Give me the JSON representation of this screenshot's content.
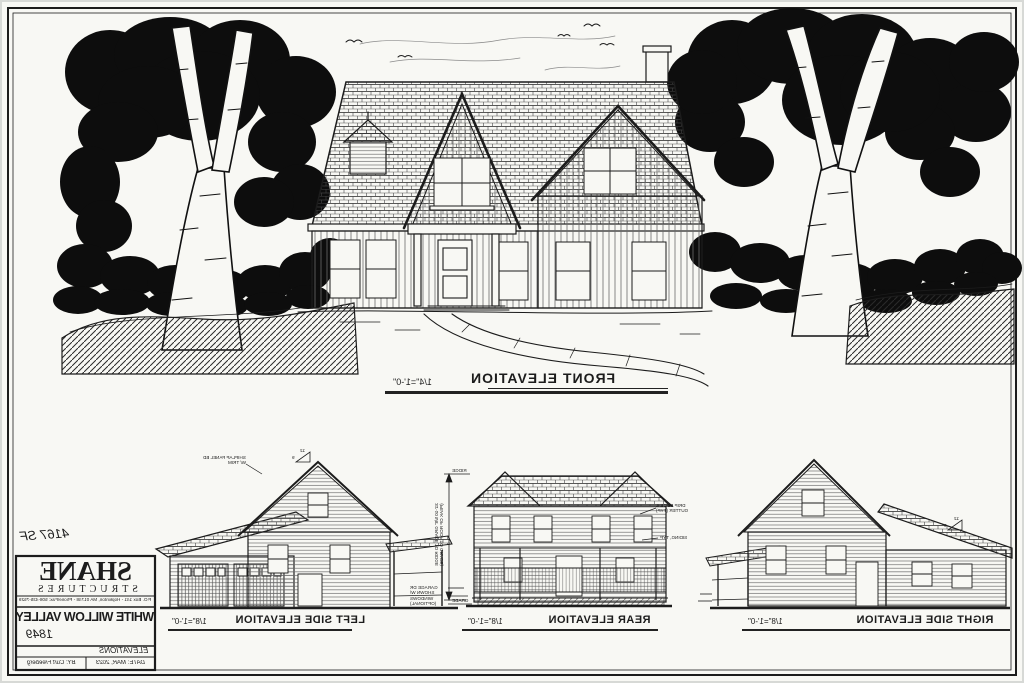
{
  "front_elevation": {
    "title": "FRONT ELEVATION",
    "scale": "1/4\"=1'-0\""
  },
  "side_elevations": [
    {
      "title": "LEFT SIDE ELEVATION",
      "scale": "1/8\"=1'-0\""
    },
    {
      "title": "REAR ELEVATION",
      "scale": "1/8\"=1'-0\""
    },
    {
      "title": "RIGHT SIDE ELEVATION",
      "scale": "1/8\"=1'-0\""
    }
  ],
  "title_block": {
    "area": "4167 SF",
    "company": "SHANE",
    "company_sub": "STRUCTURES",
    "address": "P.O. Box 141 - Hopkinton, MA 01748 - Phone/Fax: 508-435-7529",
    "project": "WHITE WILLOW VALLEY",
    "plan_no": "1849",
    "sheet_title": "ELEVATIONS",
    "drawn_by": "BY: Curt Freeberg",
    "date": "DATE: MAR, 2023"
  },
  "annotations": {
    "left_note_1": "SHIPLAP PANEL BD",
    "left_note_2": "W/ TRIM",
    "pitch_rise": "12",
    "pitch_run": "9",
    "garage": [
      "GARAGE DR",
      "SHOWN W/",
      "WINDOWS",
      "(OPTIONAL)"
    ],
    "rear_dim_line_1": "31'-10 5/8\" GRADE TO RIDGE",
    "rear_dim_line_2": "(PEAK OF ROOF TO GRADE)",
    "rear_dim_top": "RIDGE",
    "rear_dim_bottom": "GRADE",
    "rear_note_1a": "DRIP EDGE &",
    "rear_note_1b": "GUTTER (TYP)",
    "rear_note_2": "SIDING, TYP"
  },
  "colors": {
    "ink": "#1c1c1c",
    "paper": "#f8f8f4"
  }
}
